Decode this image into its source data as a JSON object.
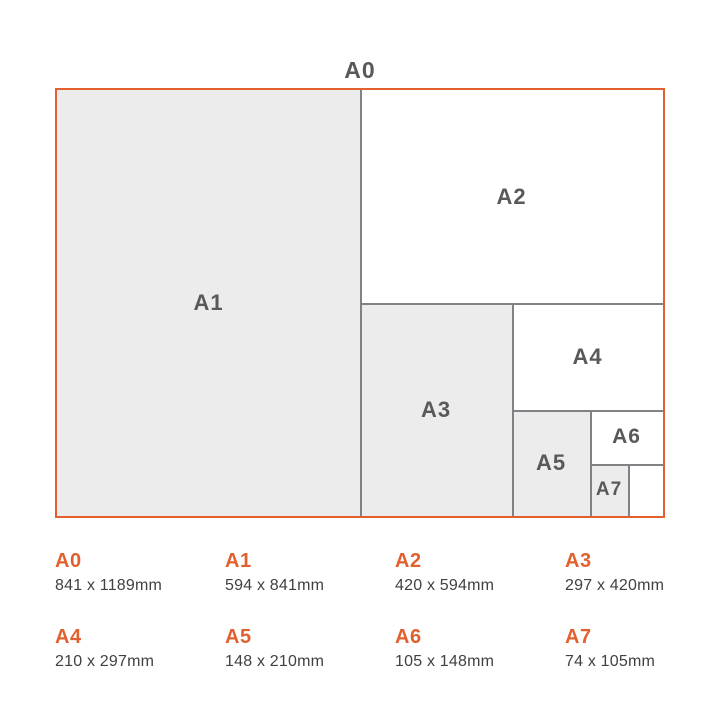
{
  "colors": {
    "accent_orange": "#e2602e",
    "region_label_gray": "#58595b",
    "dimensions_text": "#414042",
    "region_fill_gray": "#ececec",
    "divider_line_gray": "#808285"
  },
  "diagram": {
    "a0_label": "A0",
    "regions": [
      {
        "label": "A1"
      },
      {
        "label": "A2"
      },
      {
        "label": "A3"
      },
      {
        "label": "A4"
      },
      {
        "label": "A5"
      },
      {
        "label": "A6"
      },
      {
        "label": "A7"
      }
    ]
  },
  "legend": {
    "items": [
      {
        "label": "A0",
        "dimensions": "841 x 1189mm"
      },
      {
        "label": "A1",
        "dimensions": "594 x 841mm"
      },
      {
        "label": "A2",
        "dimensions": "420 x 594mm"
      },
      {
        "label": "A3",
        "dimensions": "297 x 420mm"
      },
      {
        "label": "A4",
        "dimensions": "210 x 297mm"
      },
      {
        "label": "A5",
        "dimensions": "148 x 210mm"
      },
      {
        "label": "A6",
        "dimensions": "105 x 148mm"
      },
      {
        "label": "A7",
        "dimensions": "74 x 105mm"
      }
    ]
  }
}
